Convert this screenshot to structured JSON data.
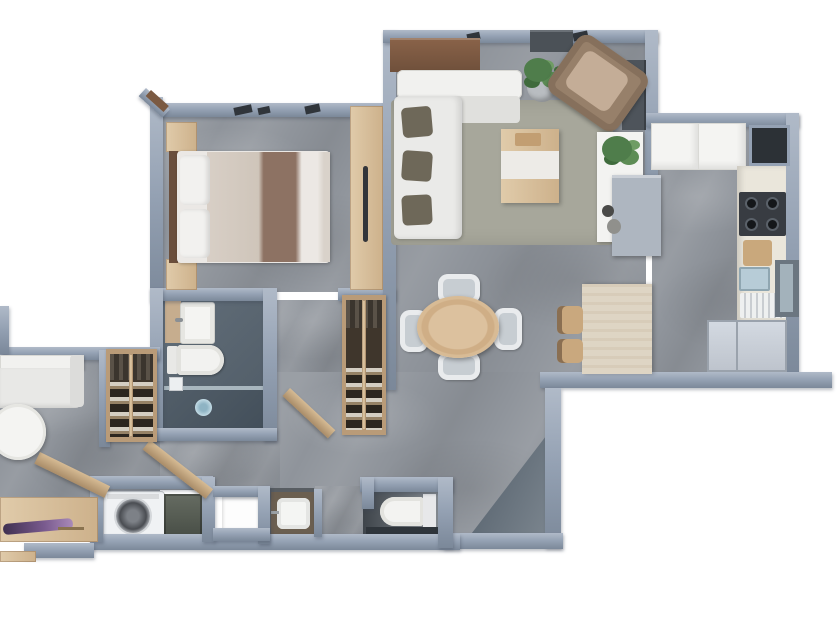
{
  "type": "3d-floor-plan-render",
  "visible_text": [],
  "palette": {
    "wall": "#94a1b3",
    "wall_light": "#b0bac8",
    "wall_dark": "#7b8899",
    "marble": "#8f949b",
    "bath_floor": "#5d6974",
    "shower_floor": "#4c5862",
    "dark_tile": "#2f353b",
    "wood": "#d8c2a2",
    "wood_mid": "#c9a87e",
    "wood_dark": "#7d5a43",
    "rug": "#a7a79b",
    "sofa_white": "#eaeae8",
    "cushion_dark": "#6e6859",
    "bed_beige": "#cfc5ba",
    "bed_brown": "#8d7263",
    "armchair": "#97806a",
    "armchair_seat": "#c4ad97",
    "plant_green": "#4f7d4b",
    "island_stone": "#ded5c4",
    "counter": "#eae6db",
    "cooktop": "#383c42",
    "sink_blue": "#b7ccd7",
    "fridge": "#c8ced6",
    "cabinet_gray": "#aeb6c0",
    "dark_fixture": "#4e545b",
    "heater": "#565c54",
    "wardrobe_dark": "#3f362c",
    "flowers": "#6b4f86",
    "glass": "#b7c6cd",
    "fixture_white": "#f3f3f1"
  },
  "rooms": [
    {
      "id": "bedroom"
    },
    {
      "id": "living-room"
    },
    {
      "id": "dining-area"
    },
    {
      "id": "kitchen"
    },
    {
      "id": "bathroom"
    },
    {
      "id": "hallway"
    },
    {
      "id": "second-lounge"
    },
    {
      "id": "laundry-room"
    },
    {
      "id": "utility-shaft"
    },
    {
      "id": "guest-toilet"
    },
    {
      "id": "entry"
    }
  ],
  "furniture": {
    "bedroom": [
      "double-bed",
      "pillows",
      "nightstand-left-top",
      "nightstand-left-bottom",
      "dresser",
      "tv"
    ],
    "living_room": [
      "corner-sofa",
      "dark-cushions",
      "brown-armchair",
      "coffee-table",
      "area-rug",
      "console-table",
      "potted-plant",
      "divider-shelf-with-plant",
      "gray-cabinet",
      "wall-shelf"
    ],
    "dining_area": [
      "round-table",
      "four-chairs",
      "island-counter",
      "two-stools"
    ],
    "kitchen": [
      "upper-cabinets",
      "dark-niche",
      "counter-run",
      "gas-cooktop",
      "cutting-board",
      "sink",
      "drying-rack",
      "fridge",
      "glass-cabinet"
    ],
    "bathroom": [
      "vanity-sink",
      "toilet",
      "shower",
      "glass-screen",
      "floor-drain"
    ],
    "second_lounge": [
      "sofa",
      "round-side-table",
      "wardrobe-shoe-shelves",
      "desk",
      "flower-bouquet"
    ],
    "laundry_room": [
      "washing-machine",
      "water-heater",
      "counter-strip"
    ],
    "utility": [
      "white-shaft",
      "small-sink"
    ],
    "guest_toilet": [
      "toilet"
    ],
    "hallway": [
      "shoe-cabinet",
      "open-doors"
    ]
  }
}
